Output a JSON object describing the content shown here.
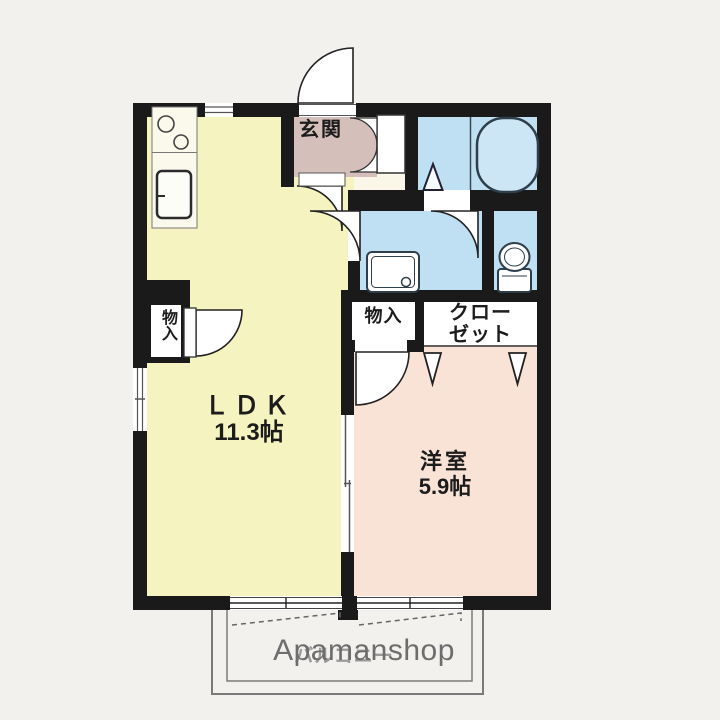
{
  "title": "apartment-floor-plan",
  "watermark": {
    "brand": "Apamanshop"
  },
  "rooms": {
    "ldk": {
      "name": "ＬＤＫ",
      "size": "11.3帖"
    },
    "western_room": {
      "name": "洋室",
      "size": "5.9帖"
    },
    "entrance": {
      "label": "玄関"
    },
    "storage_left": {
      "label": "物入"
    },
    "storage_center": {
      "label": "物入"
    },
    "closet": {
      "label": "クロー\nゼット"
    },
    "balcony": {
      "label": "バルコニー"
    }
  },
  "icons": [
    "bathtub-icon",
    "toilet-icon",
    "washbasin-icon",
    "stove-burners-icon",
    "kitchen-sink-icon",
    "entrance-door-swing-icon",
    "door-swing-arc-icon",
    "folding-door-marker-icon",
    "sliding-window-icon",
    "shoe-cabinet-icon"
  ],
  "colors": {
    "wall": "#1a1a1a",
    "ldk_floor": "#f5f3c0",
    "western_floor": "#f8e3d6",
    "wet_area_floor": "#bfe0f2",
    "entrance_floor": "#d5bfba",
    "hallway_strip": "#faf7e9",
    "bathtub_fill": "#cde6f5",
    "balcony_line": "#7a7a7a",
    "watermark_gray": "#6d6d6d"
  }
}
